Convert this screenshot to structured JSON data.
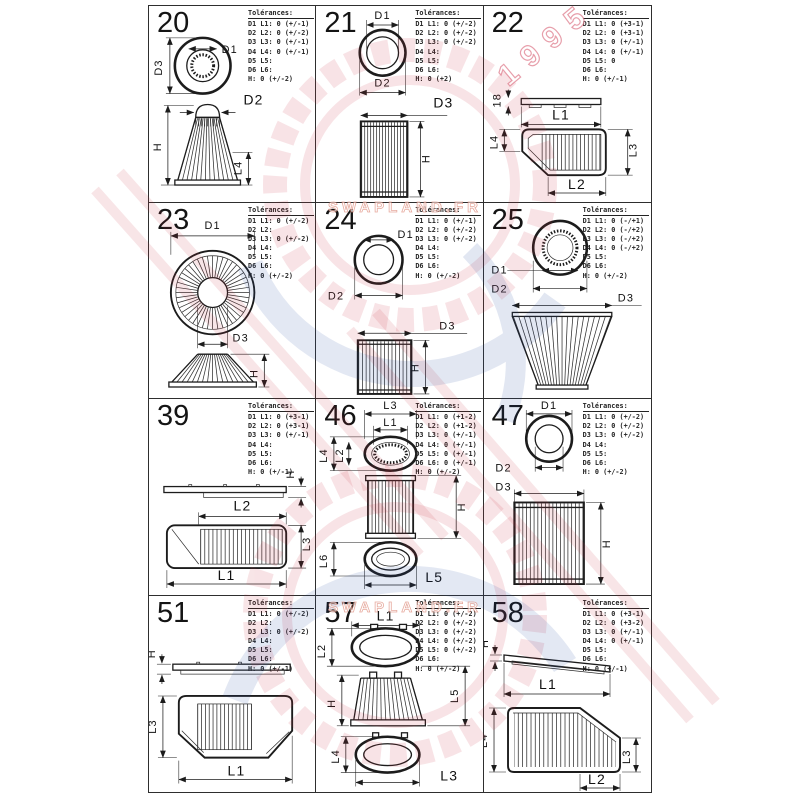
{
  "page": {
    "background": "#ffffff",
    "line_color": "#1c1c1c"
  },
  "watermark": {
    "brand": "SWAPLAND.FR",
    "year": "1995",
    "red": "#cc3344",
    "blue": "#2a4fa0"
  },
  "tol_title": "Tolérances:",
  "cells": [
    {
      "id": "20",
      "tol": [
        "D1 L1: 0 (+/-1)",
        "D2 L2: 0 (+/-2)",
        "D3 L3: 0 (+/-1)",
        "D4 L4: 0 (+/-1)",
        "D5 L5:",
        "D6 L6:",
        "H: 0 (+/-2)"
      ],
      "labels": {
        "d1": "D1",
        "d2": "D2",
        "d3": "D3",
        "h": "H",
        "l4": "L4"
      }
    },
    {
      "id": "21",
      "tol": [
        "D1 L1: 0 (+/-2)",
        "D2 L2: 0 (+/-2)",
        "D3 L3: 0 (+/-2)",
        "D4 L4:",
        "D5 L5:",
        "D6 L6:",
        "H: 0 (+2)"
      ],
      "labels": {
        "d1": "D1",
        "d2": "D2",
        "d3": "D3",
        "h": "H"
      }
    },
    {
      "id": "22",
      "tol": [
        "D1 L1: 0 (+3-1)",
        "D2 L2: 0 (+3-1)",
        "D3 L3: 0 (+/-1)",
        "D4 L4: 0 (+/-1)",
        "D5 L5: 0",
        "D6 L6:",
        "H: 0 (+/-1)"
      ],
      "labels": {
        "t18": "18",
        "l1": "L1",
        "l2": "L2",
        "l3": "L3",
        "l4": "L4"
      }
    },
    {
      "id": "23",
      "tol": [
        "D1 L1: 0 (+/-2)",
        "D2 L2:",
        "D3 L3: 0 (+/-2)",
        "D4 L4:",
        "D5 L5:",
        "D6 L6:",
        "H: 0 (+/-2)"
      ],
      "labels": {
        "d1": "D1",
        "d3": "D3",
        "h": "H"
      }
    },
    {
      "id": "24",
      "tol": [
        "D1 L1: 0 (+/-1)",
        "D2 L2: 0 (+/-2)",
        "D3 L3: 0 (+/-2)",
        "D4 L4:",
        "D5 L5:",
        "D6 L6:",
        "H: 0 (+/-2)"
      ],
      "labels": {
        "d1": "D1",
        "d2": "D2",
        "d3": "D3",
        "h": "H"
      }
    },
    {
      "id": "25",
      "tol": [
        "D1 L1: 0 (-/+1)",
        "D2 L2: 0 (-/+2)",
        "D3 L3: 0 (-/+2)",
        "D4 L4: 0 (-/+2)",
        "D5 L5:",
        "D6 L6:",
        "H: 0 (+/-2)"
      ],
      "labels": {
        "d1": "D1",
        "d2": "D2",
        "d3": "D3"
      }
    },
    {
      "id": "39",
      "tol": [
        "D1 L1: 0 (+3-1)",
        "D2 L2: 0 (+3-1)",
        "D3 L3: 0 (+/-1)",
        "D4 L4:",
        "D5 L5:",
        "D6 L6:",
        "H: 0 (+/-1)"
      ],
      "labels": {
        "h": "H",
        "l1": "L1",
        "l2": "L2",
        "l3": "L3"
      }
    },
    {
      "id": "46",
      "tol": [
        "D1 L1: 0 (+1-2)",
        "D2 L2: 0 (+1-2)",
        "D3 L3: 0 (+/-1)",
        "D4 L4: 0 (+/-1)",
        "D5 L5: 0 (+/-1)",
        "D6 L6: 0 (+/-1)",
        "H: 0 (+/-2)"
      ],
      "labels": {
        "l1": "L1",
        "l2": "L2",
        "l3": "L3",
        "l4": "L4",
        "l5": "L5",
        "l6": "L6",
        "h": "H"
      }
    },
    {
      "id": "47",
      "tol": [
        "D1 L1: 0 (+/-2)",
        "D2 L2: 0 (+/-2)",
        "D3 L3: 0 (+/-2)",
        "D4 L4:",
        "D5 L5:",
        "D6 L6:",
        "H: 0 (+/-2)"
      ],
      "labels": {
        "d1": "D1",
        "d2": "D2",
        "d3": "D3",
        "h": "H"
      }
    },
    {
      "id": "51",
      "tol": [
        "D1 L1: 0 (+/-2)",
        "D2 L2:",
        "D3 L3: 0 (+/-2)",
        "D4 L4:",
        "D5 L5:",
        "D6 L6:",
        "H: 0 (+/-1)"
      ],
      "labels": {
        "h": "H",
        "l1": "L1",
        "l3": "L3"
      }
    },
    {
      "id": "57",
      "tol": [
        "D1 L1: 0 (+/-2)",
        "D2 L2: 0 (+/-2)",
        "D3 L3: 0 (+/-2)",
        "D4 L4: 0 (+/-2)",
        "D5 L5: 0 (+/-2)",
        "D6 L6:",
        "H: 0 (+/-2)"
      ],
      "labels": {
        "l1": "L1",
        "l2": "L2",
        "l3": "L3",
        "l4": "L4",
        "l5": "L5",
        "h": "H"
      }
    },
    {
      "id": "58",
      "tol": [
        "D1 L1: 0 (+3-1)",
        "D2 L2: 0 (+3-2)",
        "D3 L3: 0 (+/-1)",
        "D4 L4: 0 (+/-1)",
        "D5 L5:",
        "D6 L6:",
        "H: 0 (+/-1)"
      ],
      "labels": {
        "h": "H",
        "l1": "L1",
        "l2": "L2",
        "l3": "L3",
        "l4": "L4"
      }
    }
  ]
}
